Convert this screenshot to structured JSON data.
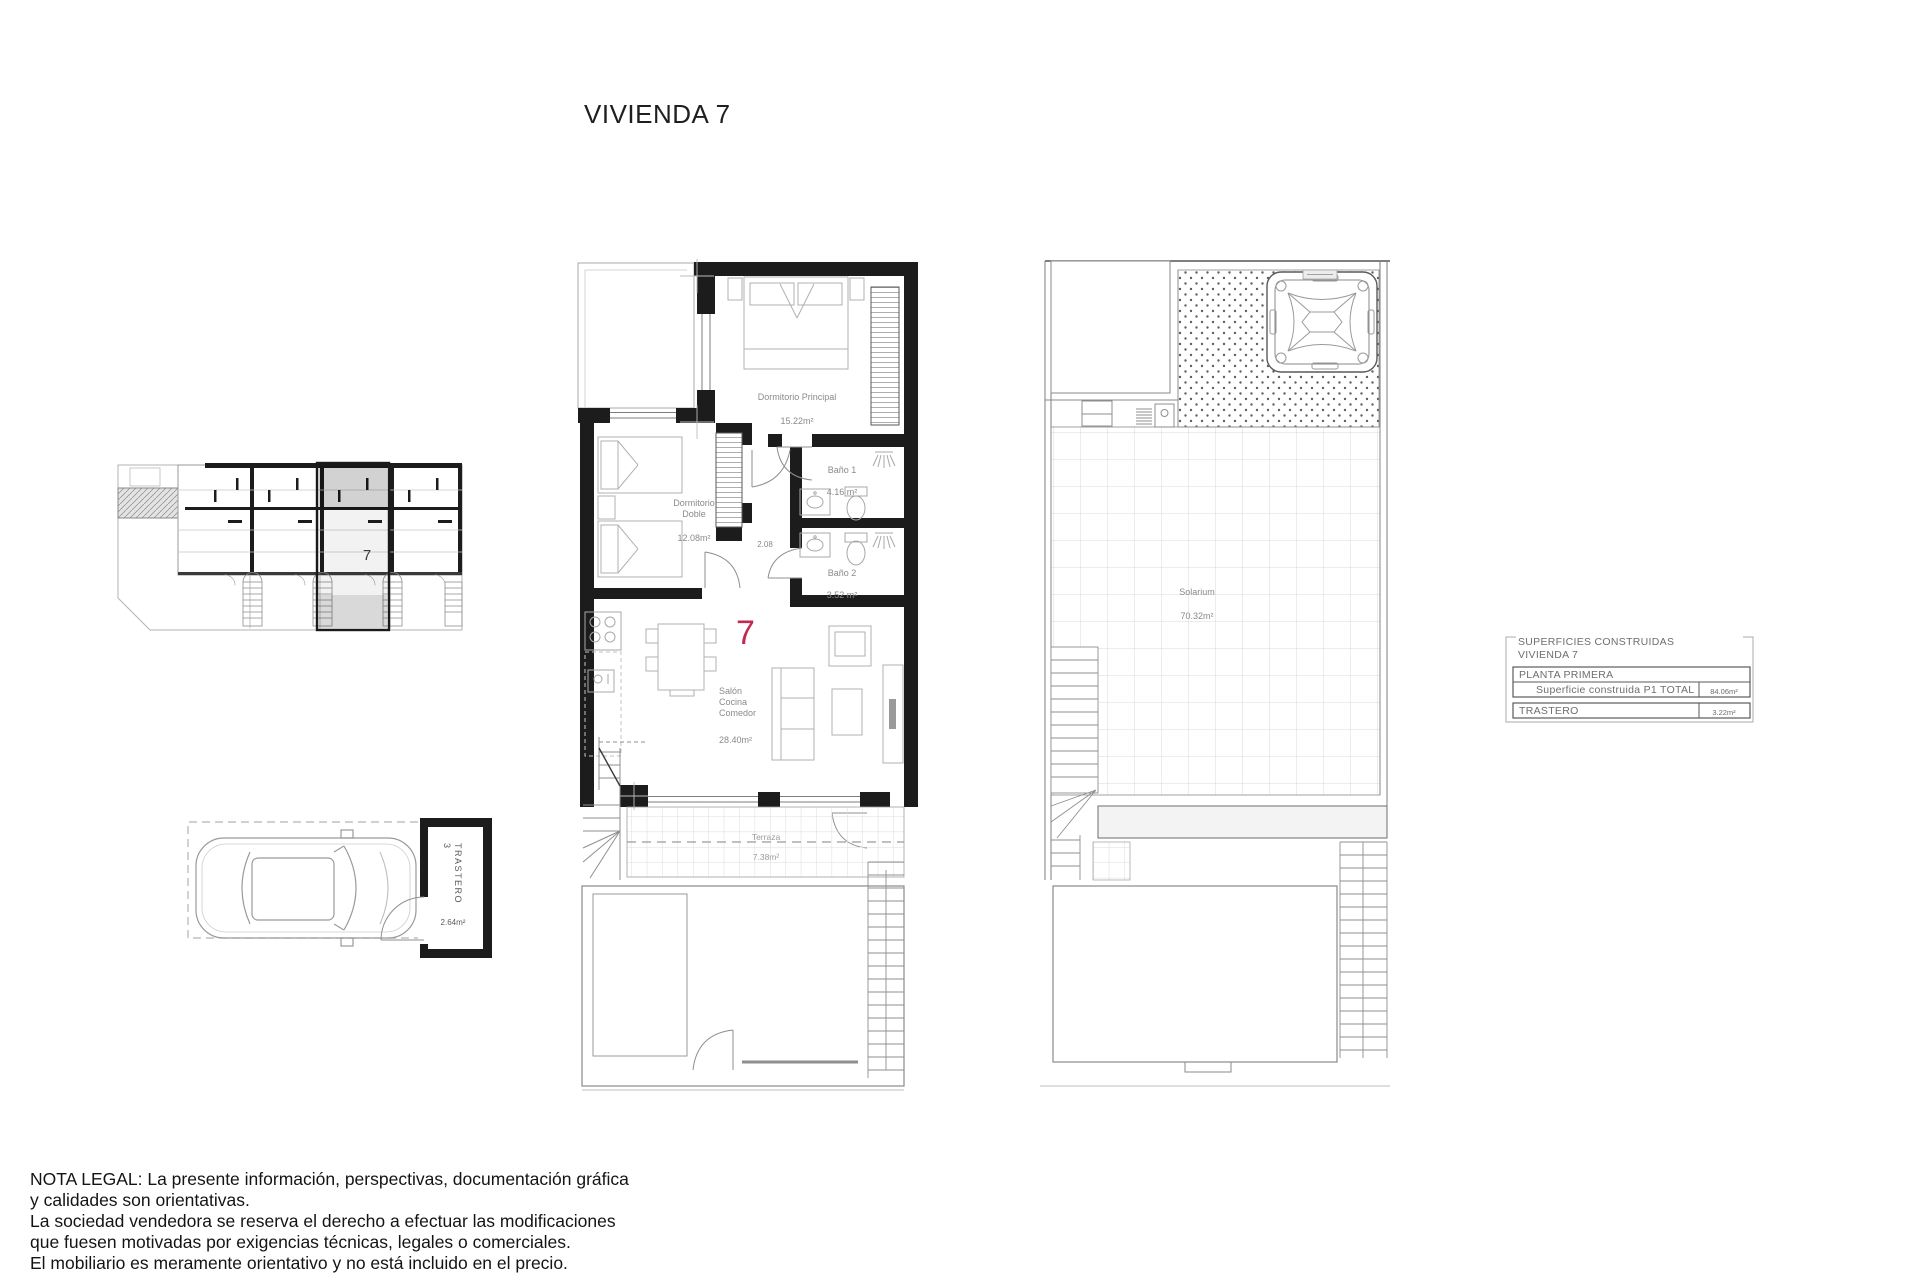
{
  "sheet": {
    "title": "VIVIENDA 7"
  },
  "colors": {
    "accent": "#c22a52",
    "wall": "#1c1c1c"
  },
  "key_plan": {
    "unit_number": "7"
  },
  "main_plan": {
    "unit_number": "7",
    "rooms": {
      "dormitorio_principal": {
        "name": "Dormitorio Principal",
        "area": "15.22m²"
      },
      "bano1": {
        "name": "Baño 1",
        "area": "4.16 m²"
      },
      "dormitorio_doble": {
        "name": "Dormitorio\nDoble",
        "area": "12.08m²"
      },
      "hall_dim": "2.08",
      "bano2": {
        "name": "Baño 2",
        "area": "3.52 m²"
      },
      "salon": {
        "name": "Salón\nCocina\nComedor",
        "area": "28.40m²"
      },
      "terraza": {
        "name": "Terraza",
        "area": "7.38m²"
      }
    }
  },
  "solarium_plan": {
    "name": "Solarium",
    "area": "70.32m²"
  },
  "garage": {
    "trastero_name": "TRASTERO 3",
    "trastero_area": "2.64m²"
  },
  "summary_table": {
    "header_line1": "SUPERFICIES CONSTRUIDAS",
    "header_line2": "VIVIENDA 7",
    "row1_label": "PLANTA PRIMERA",
    "row2_label": "Superficie construida P1 TOTAL",
    "row2_value": "84.06m²",
    "row3_label": "TRASTERO",
    "row3_value": "3.22m²"
  },
  "legal_note": {
    "text": "NOTA LEGAL: La presente información, perspectivas, documentación gráfica\ny calidades son orientativas.\nLa sociedad vendedora se reserva el derecho a efectuar las modificaciones\nque fuesen motivadas por exigencias técnicas, legales o comerciales.\nEl mobiliario es meramente orientativo y no está incluido en el precio."
  }
}
